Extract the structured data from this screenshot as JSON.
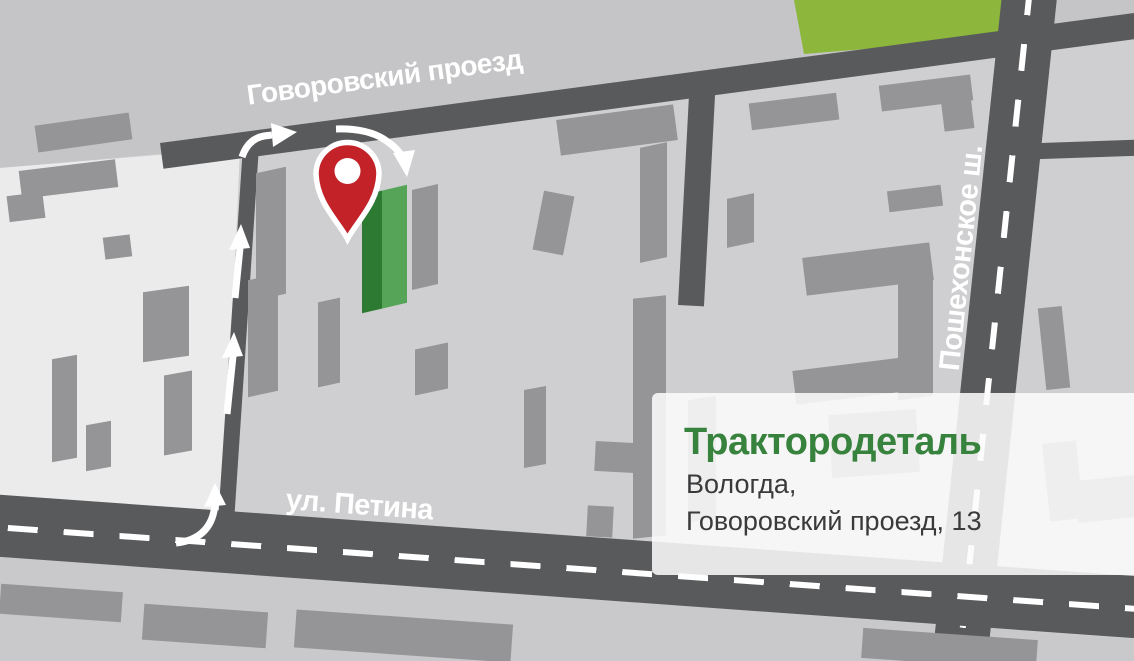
{
  "map": {
    "streets": {
      "govorovsky": "Говоровский проезд",
      "petina": "ул. Петина",
      "poshekhonskoe": "Пошехонское ш."
    },
    "card": {
      "title": "Трактородеталь",
      "address_line1": "Вологда,",
      "address_line2": "Говоровский проезд, 13"
    },
    "icons": {
      "pin": "location-pin"
    },
    "colors": {
      "road": "#595a5c",
      "block": "#cfcfd1",
      "block_light": "#ebebec",
      "band": "#c5c5c7",
      "strip": "#c9c9cb",
      "building": "#959597",
      "park": "#8cb63c",
      "pin_red": "#c32229",
      "green_dark": "#2d7a33",
      "green_light": "#55a457",
      "title_green": "#37823d",
      "addr": "#3a3a3c"
    }
  }
}
